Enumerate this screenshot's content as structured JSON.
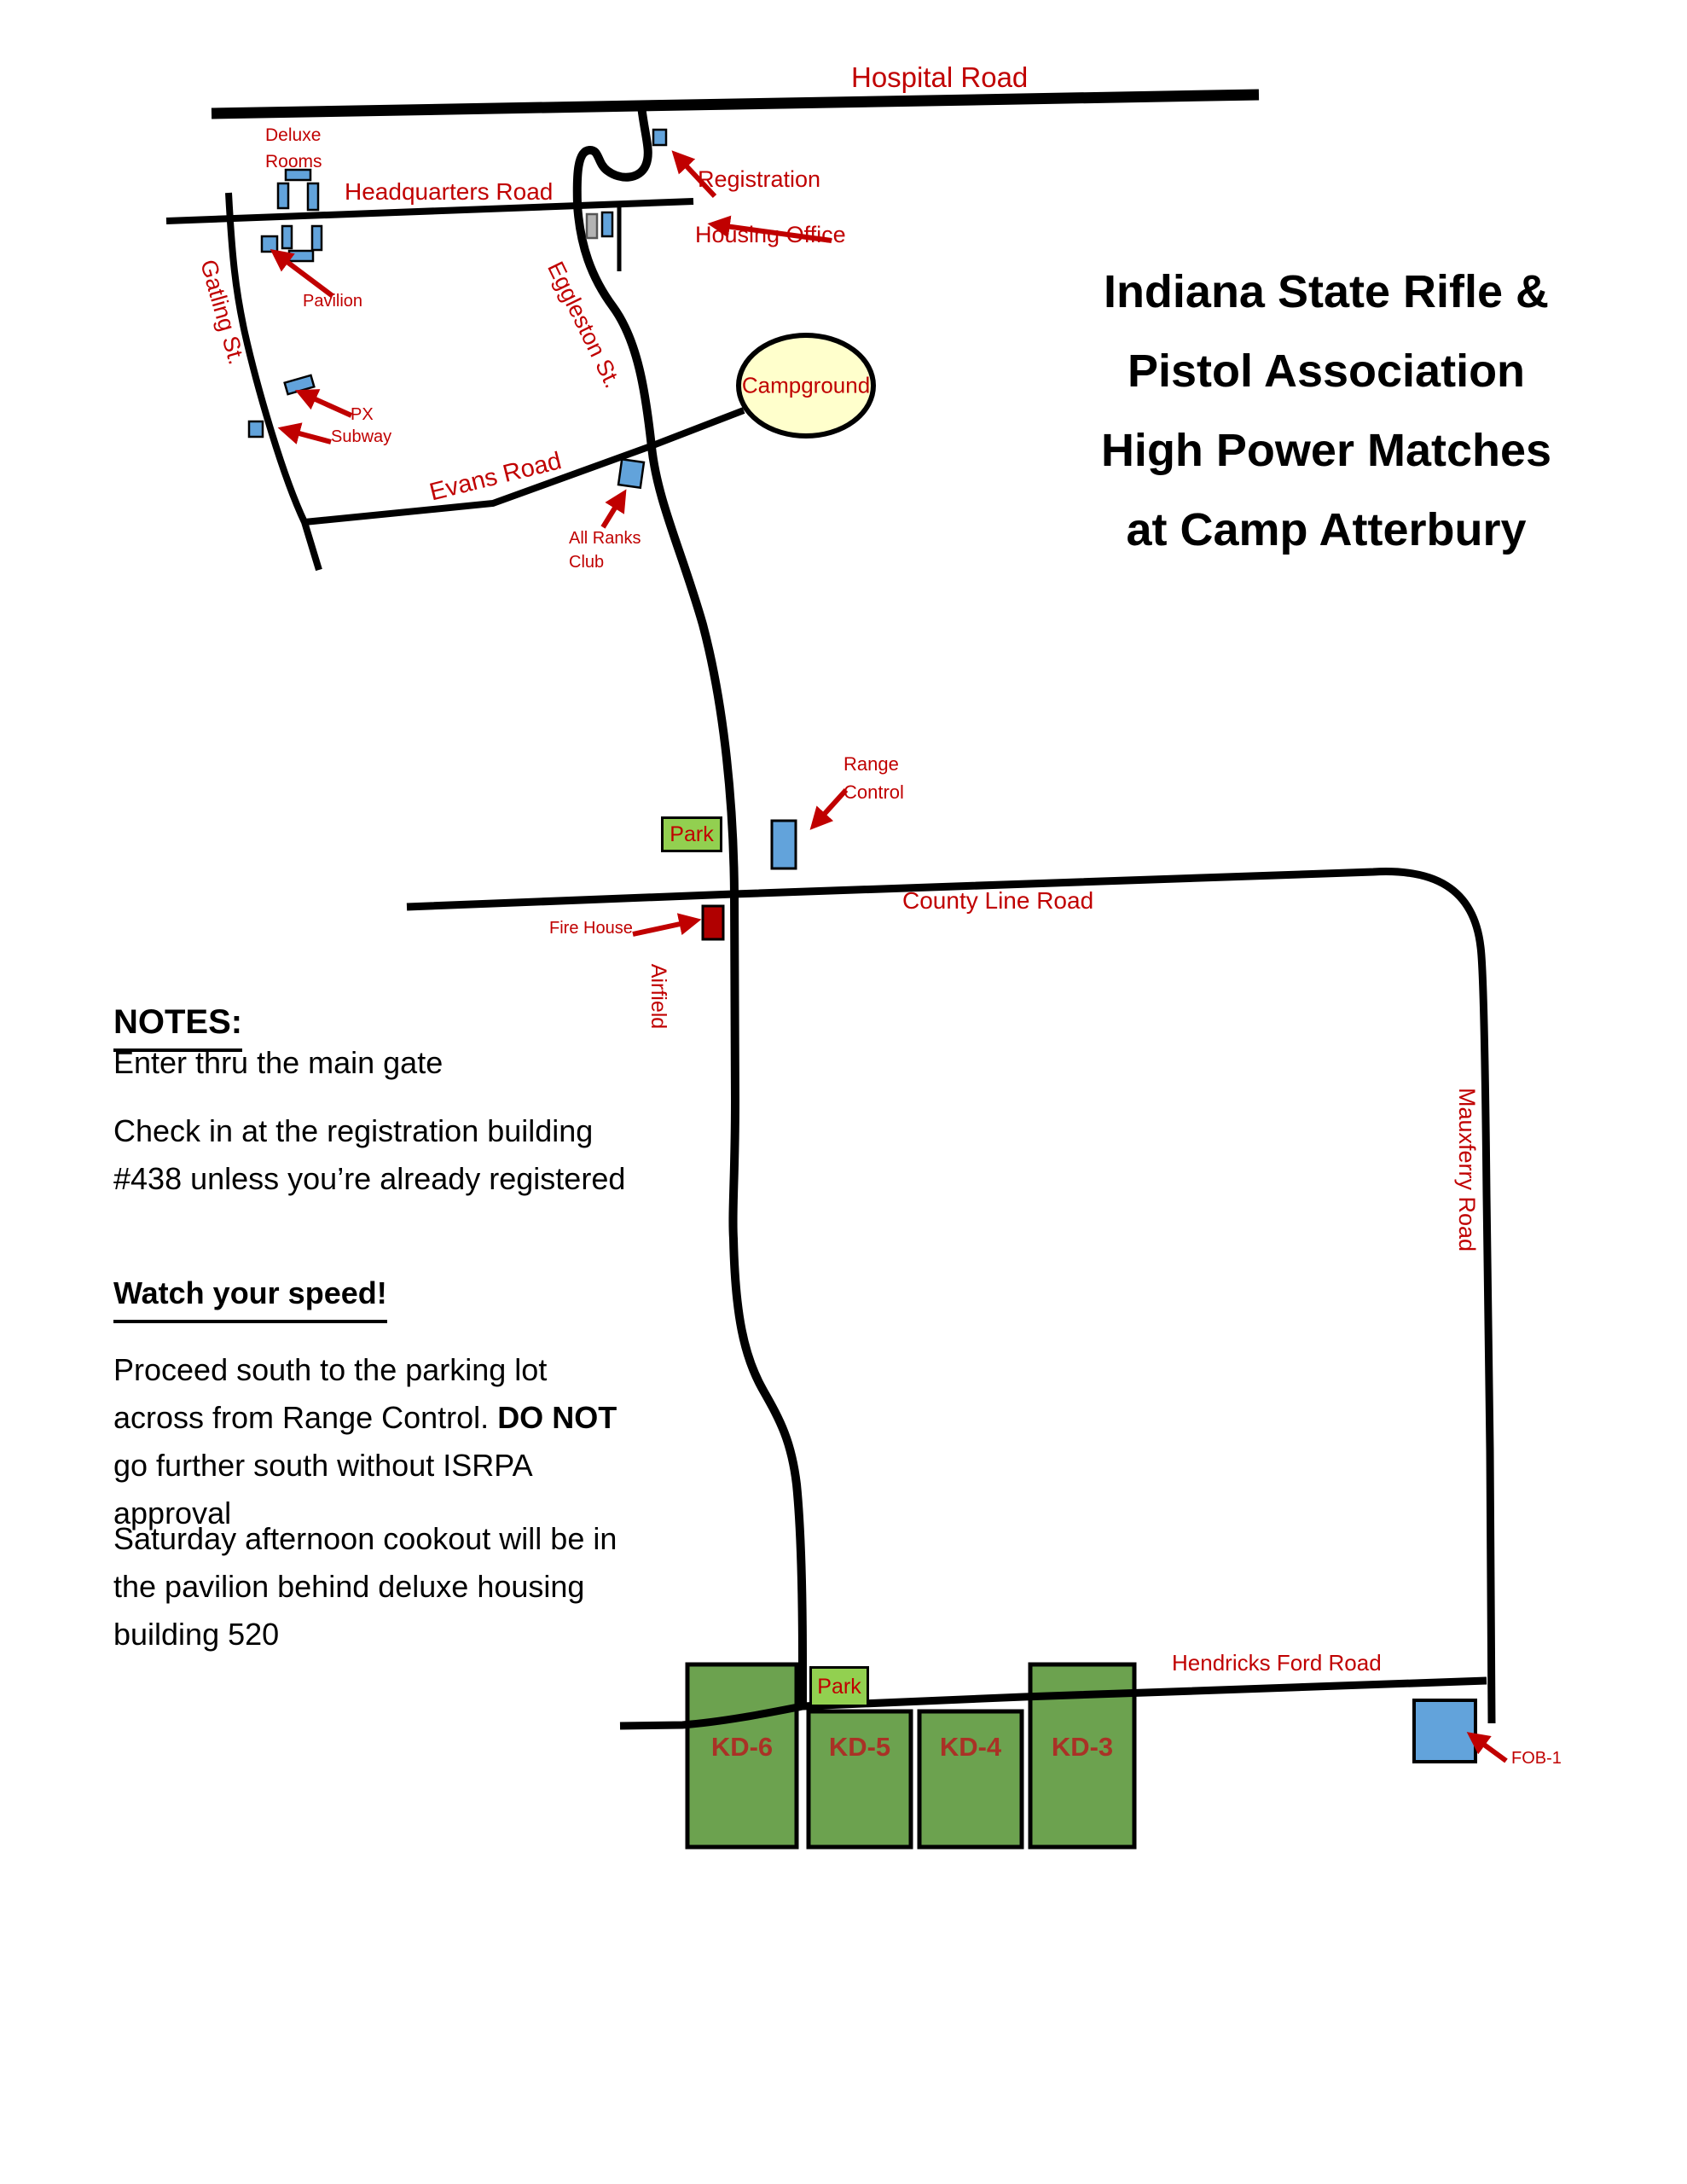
{
  "colors": {
    "road_black": "#000000",
    "label_red": "#C00000",
    "building_blue": "#62A3DB",
    "building_gray": "#B3B3B3",
    "fire_red": "#B00000",
    "campground_yellow": "#FFFFCC",
    "park_green": "#92D050",
    "range_green": "#6CA24F",
    "kd_text_red": "#A93226",
    "title_black": "#000000"
  },
  "title": {
    "lines": [
      "Indiana State Rifle &",
      "Pistol Association",
      "High Power Matches",
      "at Camp Atterbury"
    ]
  },
  "roads": {
    "hospital": "Hospital Road",
    "headquarters": "Headquarters Road",
    "gatling": "Gatling St.",
    "eggleston": "Eggleston St.",
    "evans": "Evans Road",
    "county_line": "County Line Road",
    "mauxferry": "Mauxferry Road",
    "hendricks_ford": "Hendricks Ford Road"
  },
  "areas": {
    "airfield": "Airfield",
    "campground": "Campground"
  },
  "places": {
    "deluxe_rooms": "Deluxe\nRooms",
    "registration": "Registration",
    "housing_office": "Housing Office",
    "pavilion": "Pavilion",
    "px": "PX",
    "subway": "Subway",
    "all_ranks_club": "All Ranks\nClub",
    "range_control": "Range\nControl",
    "park_north": "Park",
    "park_south": "Park",
    "fire_house": "Fire House",
    "fob1": "FOB-1"
  },
  "ranges": {
    "kd6": "KD-6",
    "kd5": "KD-5",
    "kd4": "KD-4",
    "kd3": "KD-3"
  },
  "notes": {
    "heading": "NOTES:",
    "p1": "Enter thru the main gate",
    "p2": "Check in at the registration building\n#438 unless you’re already registered",
    "watch": "Watch your speed!",
    "p3_before": "Proceed south to the parking lot\nacross from Range Control.  ",
    "p3_bold": "DO NOT",
    "p3_after": "\ngo further south without ISRPA\napproval",
    "p4": "Saturday afternoon cookout will be in\nthe pavilion behind deluxe housing\nbuilding 520"
  }
}
